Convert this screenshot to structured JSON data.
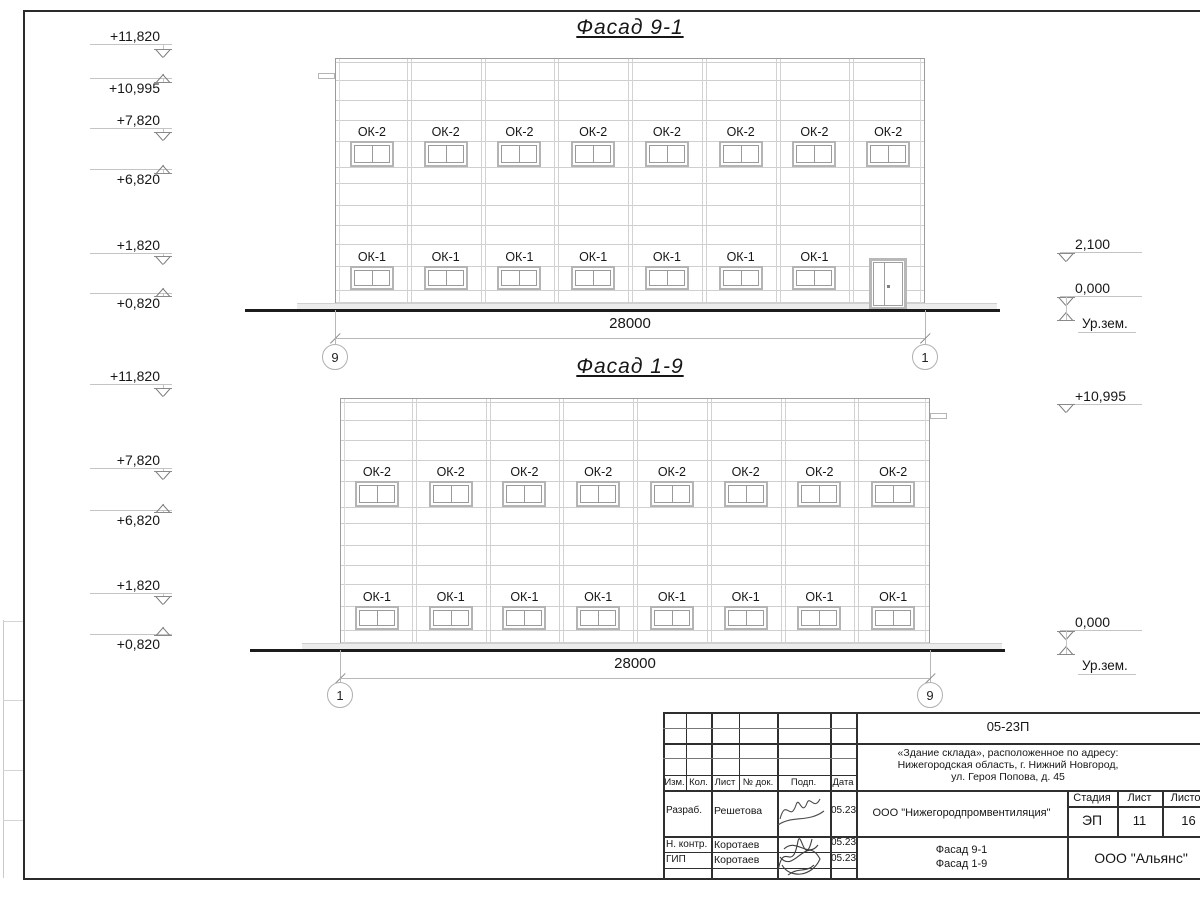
{
  "facades": [
    {
      "name": "facade-9-1",
      "title": "Фасад 9-1",
      "dimension": "28000",
      "axis_left": "9",
      "axis_right": "1",
      "window_top_label": "ОК-2",
      "window_top_count": 8,
      "window_bottom_label": "ОК-1",
      "window_bottom_count": 7,
      "has_door": true,
      "marks": [
        "+11,820",
        "+10,995",
        "+7,820",
        "+6,820",
        "+1,820",
        "+0,820",
        "2,100",
        "0,000"
      ],
      "ground_label": "Ур.зем."
    },
    {
      "name": "facade-1-9",
      "title": "Фасад 1-9",
      "dimension": "28000",
      "axis_left": "1",
      "axis_right": "9",
      "window_top_label": "ОК-2",
      "window_top_count": 8,
      "window_bottom_label": "ОК-1",
      "window_bottom_count": 8,
      "has_door": false,
      "marks": [
        "+11,820",
        "+7,820",
        "+6,820",
        "+1,820",
        "+0,820",
        "+10,995",
        "0,000"
      ],
      "ground_label": "Ур.зем."
    }
  ],
  "stamp": {
    "doc_number": "05-23П",
    "address_lines": [
      "«Здание склада», расположенное по адресу:",
      "Нижегородская область, г. Нижний Новгород,",
      "ул. Героя Попова, д. 45"
    ],
    "header_cols": [
      "Изм.",
      "Кол.",
      "Лист",
      "№ док.",
      "Подп.",
      "Дата"
    ],
    "rows": [
      {
        "role": "Разраб.",
        "name": "Решетова",
        "date": "05.23"
      },
      {
        "role": "Н. контр.",
        "name": "Коротаев",
        "date": "05.23"
      },
      {
        "role": "ГИП",
        "name": "Коротаев",
        "date": "05.23"
      }
    ],
    "org": "ООО \"Нижегородпромвентиляция\"",
    "stage_header": [
      "Стадия",
      "Лист",
      "Листов"
    ],
    "stage_values": [
      "ЭП",
      "11",
      "16"
    ],
    "sheet_title_lines": [
      "Фасад 9-1",
      "Фасад 1-9"
    ],
    "company": "ООО \"Альянс\""
  }
}
